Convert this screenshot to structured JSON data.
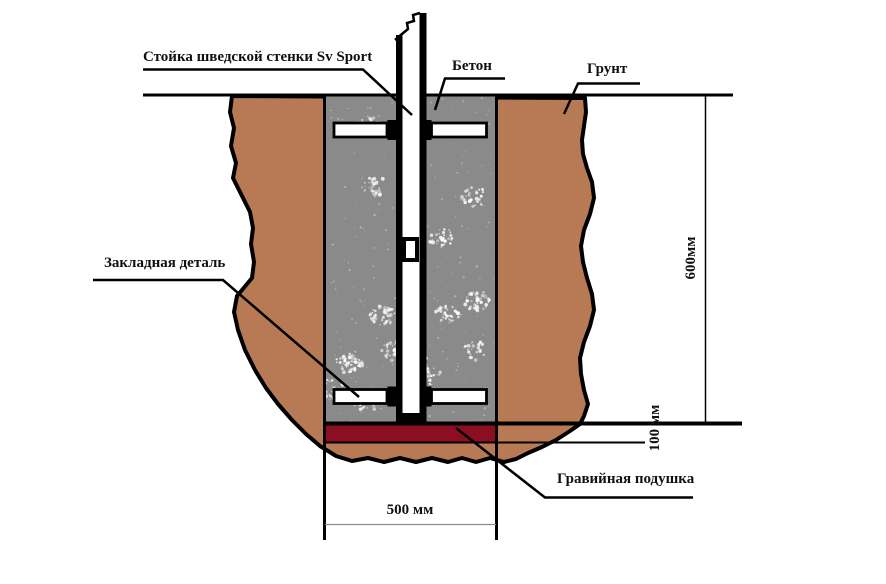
{
  "diagram": {
    "kind": "installation-cross-section",
    "labels": {
      "post": "Стойка шведской стенки Sv Sport",
      "concrete": "Бетон",
      "ground": "Грунт",
      "embedded_part": "Закладная деталь",
      "gravel_pad": "Гравийная подушка"
    },
    "dimensions": {
      "depth": "600мм",
      "gravel_thickness": "100 мм",
      "pit_width": "500 мм"
    },
    "colors": {
      "soil": "#b87a55",
      "concrete": "#8a8a8a",
      "gravel": "#8b0e22",
      "line": "#000000",
      "thin_dim_line": "#8c8c8c"
    }
  }
}
